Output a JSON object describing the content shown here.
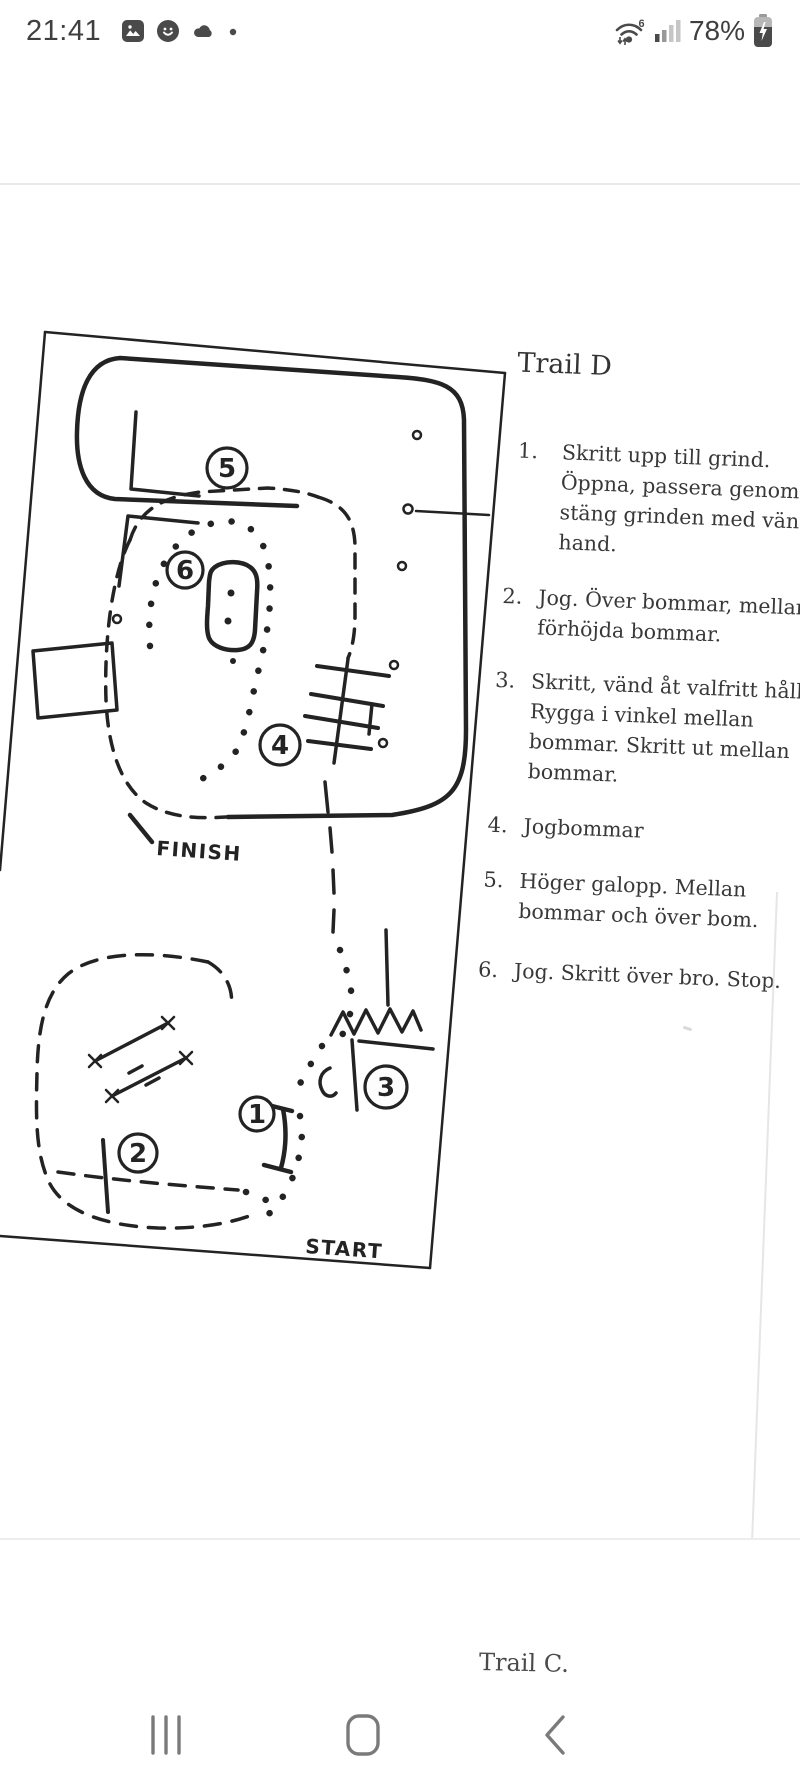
{
  "status_bar": {
    "time": "21:41",
    "battery_percent": "78%",
    "wifi_standard": "6",
    "notification_icons": [
      "gallery-icon",
      "avatar-app-icon",
      "cloud-icon",
      "more-notifications-dot"
    ],
    "system_icons": [
      "wifi-6-icon",
      "signal-bars-icon",
      "battery-charging-icon"
    ]
  },
  "photo": {
    "map": {
      "finish_label": "FINISH",
      "start_label": "START",
      "obstacles": {
        "n1": "1",
        "n2": "2",
        "n3": "3",
        "n4": "4",
        "n5": "5",
        "n6": "6"
      }
    },
    "instructions": {
      "title": "Trail D",
      "items": [
        {
          "num": "1.",
          "lines": [
            "Skritt upp till grind.",
            "Öppna, passera genom o",
            "stäng grinden med vänst",
            "hand."
          ]
        },
        {
          "num": "2.",
          "lines": [
            "Jog. Över bommar, mellan",
            "förhöjda bommar."
          ]
        },
        {
          "num": "3.",
          "lines": [
            "Skritt, vänd åt valfritt håll.",
            "Rygga i vinkel mellan",
            "bommar. Skritt ut mellan",
            "bommar."
          ]
        },
        {
          "num": "4.",
          "lines": [
            "Jogbommar"
          ]
        },
        {
          "num": "5.",
          "lines": [
            "Höger galopp. Mellan",
            "bommar och över bom."
          ]
        },
        {
          "num": "6.",
          "lines": [
            "Jog. Skritt över bro. Stop."
          ]
        }
      ]
    },
    "next_page_title": "Trail C."
  },
  "nav_bar": {
    "icons": [
      "recents-icon",
      "home-icon",
      "back-icon"
    ]
  }
}
